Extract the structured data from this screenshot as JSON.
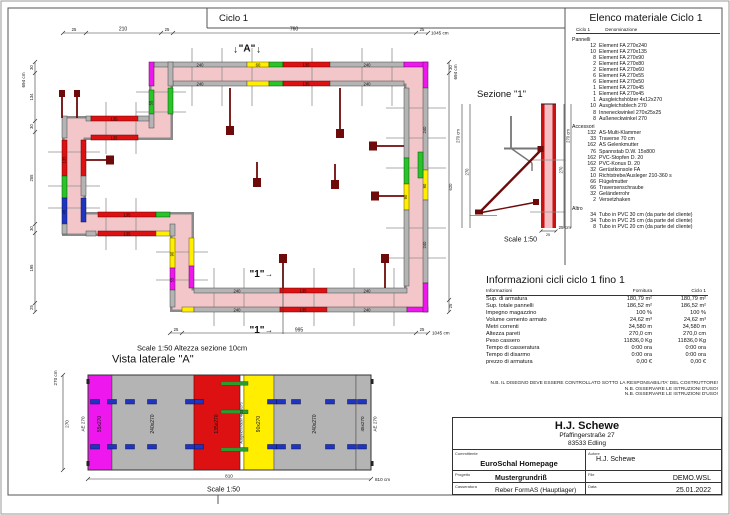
{
  "plan": {
    "title": "Ciclo 1",
    "scale_note": "Scale 1:50   Altezza sezione 10cm",
    "dims": {
      "n25": "25",
      "n30": "30",
      "n210": "210",
      "n760": "760",
      "n995": "995",
      "n1045": "1045 cm",
      "n134": "134",
      "n255": "255",
      "n195": "195",
      "n620": "620",
      "n694": "694 cm"
    },
    "panel_labels": {
      "p240": "240",
      "p135": "135",
      "p90": "90",
      "p60": "60",
      "p55": "55",
      "p45": "45"
    },
    "markers": {
      "a": "\"A\"",
      "one": "\"1\"",
      "down": "↓",
      "arrow": "→"
    }
  },
  "sezione": {
    "title": "Sezione \"1\"",
    "d270": "270",
    "d270cm": "270 cm",
    "d25": "25",
    "d25cm": "25 cm",
    "scale": "Scale 1:50"
  },
  "vista": {
    "title": "Vista laterale \"A\"",
    "scale": "Scale 1:50",
    "d270cm": "270 cm",
    "d270": "270",
    "d810": "810",
    "d810cm": "810 cm",
    "ae": "AE 270",
    "panels": [
      {
        "label": "55x270"
      },
      {
        "label": "240x270"
      },
      {
        "label": "135x270"
      },
      {
        "label": "Ausgleichshölzer 4x12x270"
      },
      {
        "label": "90x270"
      },
      {
        "label": "240x270"
      },
      {
        "label": "45x270"
      }
    ]
  },
  "elenco": {
    "title": "Elenco materiale  Ciclo 1",
    "col_ciclo": "Ciclo 1",
    "col_den": "Denominazione",
    "group1": "Pannelli",
    "group2": "Accessori",
    "group3": "Altro",
    "pannelli": [
      {
        "qty": "12",
        "name": "Element FA 270x240"
      },
      {
        "qty": "10",
        "name": "Element FA 270x135"
      },
      {
        "qty": "8",
        "name": "Element FA 270x90"
      },
      {
        "qty": "2",
        "name": "Element FA 270x80"
      },
      {
        "qty": "2",
        "name": "Element FA 270x60"
      },
      {
        "qty": "6",
        "name": "Element FA 270x55"
      },
      {
        "qty": "6",
        "name": "Element FA 270x50"
      },
      {
        "qty": "1",
        "name": "Element FA 270x45"
      },
      {
        "qty": "1",
        "name": "Element FA 270x45"
      },
      {
        "qty": "1",
        "name": "Ausgleichshölzer 4x12x270"
      },
      {
        "qty": "10",
        "name": "Ausgleichsblech 270"
      },
      {
        "qty": "8",
        "name": "Inneneckwinkel 270x25x25"
      },
      {
        "qty": "8",
        "name": "Außeneckwinkel 270"
      }
    ],
    "accessori": [
      {
        "qty": "132",
        "name": "AS-Multi-Klammer"
      },
      {
        "qty": "33",
        "name": "Traverse 70 cm"
      },
      {
        "qty": "162",
        "name": "AS Gelenkmutter"
      },
      {
        "qty": "76",
        "name": "Spannstab D.W. 15x800"
      },
      {
        "qty": "162",
        "name": "PVC-Stopfen D. 20"
      },
      {
        "qty": "162",
        "name": "PVC-Konus D. 20"
      },
      {
        "qty": "32",
        "name": "Gerüstkonsole FA"
      },
      {
        "qty": "10",
        "name": "Richtstrebe/Ausleger 210-360 s"
      },
      {
        "qty": "66",
        "name": "Flügelmutter"
      },
      {
        "qty": "66",
        "name": "Traversenschraube"
      },
      {
        "qty": "32",
        "name": "Geländerrohr"
      },
      {
        "qty": "2",
        "name": "Versetzhaken"
      }
    ],
    "altro": [
      {
        "qty": "34",
        "name": "Tubo in PVC 30 cm (da parte del cliente)"
      },
      {
        "qty": "34",
        "name": "Tubo in PVC 25 cm (da parte del cliente)"
      },
      {
        "qty": "8",
        "name": "Tubo in PVC 20 cm (da parte del cliente)"
      }
    ]
  },
  "info": {
    "title": "Informazioni cicli  ciclo 1 fino 1",
    "headers": [
      "Informazioni",
      "Fornitura",
      "Ciclo 1"
    ],
    "rows": [
      {
        "l": "Sup. di armatura",
        "f": "180,79 m²",
        "c": "180,79 m²"
      },
      {
        "l": "Sup. totale pannelli",
        "f": "186,52 m²",
        "c": "186,52 m²"
      },
      {
        "l": "Impegno magazzino",
        "f": "100 %",
        "c": "100 %"
      },
      {
        "l": "Volume cemento armato",
        "f": "24,62 m³",
        "c": "24,62 m³"
      },
      {
        "l": "Metri correnti",
        "f": "34,580 m",
        "c": "34,580 m"
      },
      {
        "l": "Altezza pareti",
        "f": "270,0 cm",
        "c": "270,0 cm"
      },
      {
        "l": "Peso cassero",
        "f": "11836,0 Kg",
        "c": "11836,0 Kg"
      },
      {
        "l": "Tempo di casseratura",
        "f": "0:00 ora",
        "c": "0:00 ora"
      },
      {
        "l": "Tempo di disarmo",
        "f": "0:00 ora",
        "c": "0:00 ora"
      },
      {
        "l": "prezzo di armatura",
        "f": "0,00 €",
        "c": "0,00 €"
      }
    ]
  },
  "notes": [
    {
      "t": "N.B. IL DISEGNO DEVE ESSERE CONTROLLATO SOTTO LA RESPONSABILITA' DEL COSTRUTTORE!"
    },
    {
      "t": "N.B. OSSERVARE LE ISTRUZIONI D'USO!"
    },
    {
      "t": "N.B. OSSERVARE LE ISTRUZIONI D'USO!"
    }
  ],
  "titleblock": {
    "company": "H.J. Schewe",
    "street": "Pfaffingerstraße 27",
    "city": "83533 Edling",
    "committente_label": "Committente",
    "committente": "EuroSchal Homepage",
    "autore_label": "Autore",
    "autore": "H.J. Schewe",
    "progetto_label": "Progetto",
    "progetto": "Mustergrundriß",
    "file_label": "File",
    "file": "DEMO.WSL",
    "casseratura_label": "Casseratura",
    "casseratura": "Reber FormAS (Hauptlager)",
    "data_label": "Data",
    "data": "25.01.2022"
  },
  "colors": {
    "wall_fill": "#f3c6ca",
    "panel_gray": "#b4b4b4",
    "panel_red": "#dd1111",
    "panel_yellow": "#ffee00",
    "panel_green": "#28c428",
    "panel_magenta": "#ee18ee",
    "panel_blue": "#1f35c0",
    "brace_dark_red": "#6f0a0a"
  }
}
